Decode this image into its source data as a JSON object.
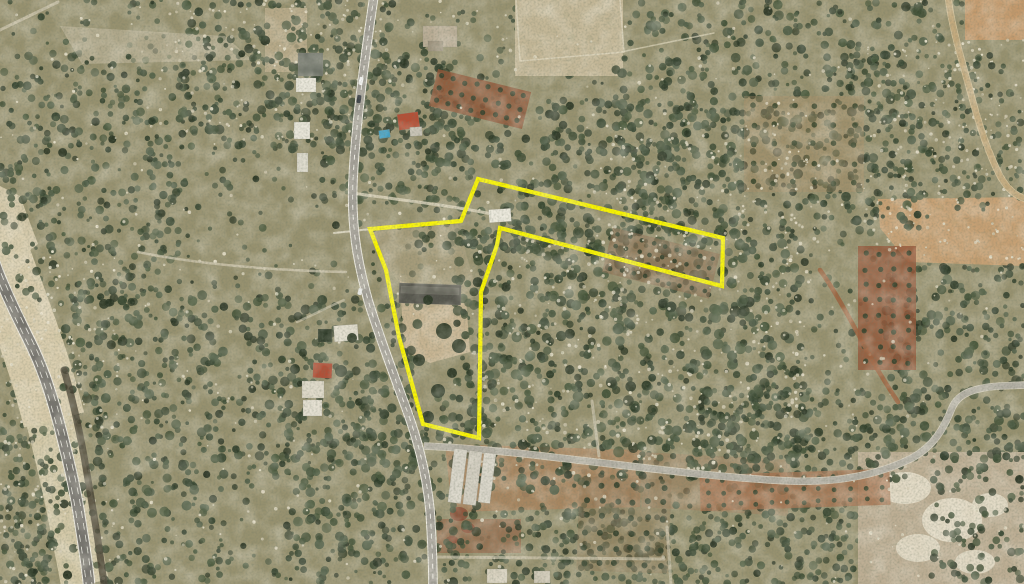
{
  "meta": {
    "title": "Aerial satellite view with highlighted land parcel",
    "width": 1024,
    "height": 584
  },
  "map": {
    "width": 1024,
    "height": 584,
    "seed": 1234,
    "base": "#97916f",
    "parcel": {
      "points": "478,179 723,238 722,286 500,228 497,245 481,292 479,438 423,424 399,337 386,270 370,229 461,221",
      "color": "#f9f400",
      "width": 4.2
    },
    "sand": [
      {
        "d": "M -8 236 C 4 268, 16 300, 30 340 C 40 368, 48 396, 54 420",
        "w": 62,
        "c": "#dbcfae",
        "o": 0.95
      },
      {
        "d": "M 50 420 C 58 452, 66 486, 72 516 C 77 544, 82 566, 85 584",
        "w": 48,
        "c": "#d8cdab",
        "o": 0.92
      }
    ],
    "channel": {
      "d": "M 64 370 C 72 396, 78 424, 84 456 C 89 486, 95 520, 99 548 C 101 562, 103 574, 104 584",
      "w": 7,
      "c": "#453e31",
      "o": 0.8
    },
    "highway": {
      "d": "M -6 262 C 2 285, 14 310, 28 338 C 42 366, 50 390, 58 420 C 66 450, 74 482, 79 514 C 83 540, 87 562, 89 584",
      "casing": "#efece3",
      "casingW": 12.6,
      "fill": "#76736e",
      "fillW": 10.6,
      "laneOffset": 2.9,
      "laneColor": "#e9e7df",
      "laneW": 0.8,
      "laneDash": "7 5"
    },
    "mainRoad": {
      "d": "M 374 -4 C 366 50, 356 120, 353 180 C 351 225, 357 260, 368 300 C 378 333, 392 370, 406 408 C 417 438, 426 470, 430 510 C 432 540, 433 565, 433 588",
      "casing": "#efece2",
      "casingW": 9.6,
      "fill": "#a5a199",
      "fillW": 7.6,
      "centerColor": "#f2f0e8",
      "centerW": 0.9,
      "centerDash": "5 5"
    },
    "ruralRoad": {
      "d": "M 424 446 C 470 448, 520 453, 560 458 C 640 467, 720 478, 790 481 C 840 483, 880 474, 912 458 C 934 446, 944 428, 952 408 C 958 394, 972 388, 1000 386 L 1026 385",
      "casing": "#d9d3c2",
      "casingW": 7.6,
      "fill": "#b2aea3",
      "fillW": 6
    },
    "dirtRoad": {
      "d": "M 948 -4 C 952 30, 962 60, 972 98 C 980 128, 988 152, 1000 176 C 1008 190, 1016 196, 1026 199",
      "casing": "#d9c79f",
      "casingW": 7,
      "fill": "#c2a97d",
      "fillW": 5.4
    },
    "patches": [
      {
        "t": "poly",
        "p": "0,186 20,196 38,244 10,266 0,264",
        "f": "#d9cdae",
        "o": 0.92
      },
      {
        "t": "rect",
        "x": 515,
        "y": 0,
        "w": 108,
        "h": 76,
        "rot": 0,
        "f": "#c9bb9b",
        "o": 0.9
      },
      {
        "t": "rect",
        "x": 265,
        "y": 8,
        "w": 42,
        "h": 64,
        "rot": 0,
        "f": "#c2b190",
        "o": 0.75
      },
      {
        "t": "poly",
        "p": "60,26 225,36 252,60 82,64",
        "f": "#cfc6ad",
        "o": 0.45
      },
      {
        "t": "rect",
        "x": 965,
        "y": 0,
        "w": 59,
        "h": 40,
        "rot": 0,
        "f": "#c59a6c",
        "o": 0.95
      },
      {
        "t": "poly",
        "p": "878,199 1024,197 1024,266 908,262 880,228",
        "f": "#c8a174",
        "o": 0.95
      },
      {
        "t": "rect",
        "x": 858,
        "y": 452,
        "w": 166,
        "h": 132,
        "rot": 0,
        "f": "#bfb096",
        "o": 0.95
      },
      {
        "t": "ellipse",
        "x": 905,
        "y": 488,
        "w": 26,
        "h": 16,
        "f": "#e9e1cd",
        "o": 0.85
      },
      {
        "t": "ellipse",
        "x": 952,
        "y": 520,
        "w": 30,
        "h": 22,
        "f": "#e9e1cd",
        "o": 0.85
      },
      {
        "t": "ellipse",
        "x": 918,
        "y": 548,
        "w": 22,
        "h": 14,
        "f": "#e9e1cd",
        "o": 0.8
      },
      {
        "t": "ellipse",
        "x": 990,
        "y": 505,
        "w": 18,
        "h": 12,
        "f": "#e9e1cd",
        "o": 0.8
      },
      {
        "t": "ellipse",
        "x": 975,
        "y": 562,
        "w": 20,
        "h": 12,
        "f": "#e9e1cd",
        "o": 0.8
      },
      {
        "t": "poly",
        "p": "400,281 466,298 470,352 430,363 404,350",
        "f": "#c9b694",
        "o": 0.95
      },
      {
        "t": "poly",
        "p": "372,232 458,224 478,296 462,300 420,310 388,268",
        "f": "#b3a686",
        "o": 0.5
      },
      {
        "t": "poly",
        "p": "445,444 642,450 640,507 452,512",
        "f": "#a9845f",
        "o": 0.85
      },
      {
        "t": "poly",
        "p": "640,452 790,460 788,516 642,507",
        "f": "#a08261",
        "o": 0.55
      },
      {
        "t": "rect",
        "x": 437,
        "y": 519,
        "w": 84,
        "h": 34,
        "rot": 0,
        "f": "#96684a",
        "o": 0.7
      },
      {
        "t": "ellipse",
        "x": 459,
        "y": 514,
        "w": 9,
        "h": 7,
        "f": "#8a4a34",
        "o": 0.8
      },
      {
        "t": "ellipse",
        "x": 468,
        "y": 528,
        "w": 7,
        "h": 5,
        "f": "#8a4a34",
        "o": 0.75
      },
      {
        "t": "ellipse",
        "x": 452,
        "y": 540,
        "w": 6,
        "h": 4,
        "f": "#8a4a34",
        "o": 0.7
      }
    ],
    "treeColors": [
      "#2e3c29",
      "#374631",
      "#3f4e35",
      "#47563b",
      "#2a3524",
      "#505e47"
    ],
    "treeZones": [
      {
        "x": 0,
        "y": 0,
        "w": 1024,
        "h": 584,
        "n": 1500,
        "rmin": 1.5,
        "rmax": 4
      },
      {
        "x": 180,
        "y": 0,
        "w": 215,
        "h": 150,
        "n": 280,
        "rmin": 2,
        "rmax": 5
      },
      {
        "x": 320,
        "y": 55,
        "w": 130,
        "h": 150,
        "n": 170,
        "rmin": 2,
        "rmax": 5
      },
      {
        "x": 415,
        "y": 100,
        "w": 330,
        "h": 150,
        "n": 400,
        "rmin": 2,
        "rmax": 5
      },
      {
        "x": 455,
        "y": 225,
        "w": 350,
        "h": 265,
        "n": 800,
        "rmin": 2,
        "rmax": 5.5
      },
      {
        "x": 615,
        "y": 0,
        "w": 320,
        "h": 235,
        "n": 420,
        "rmin": 2,
        "rmax": 5
      },
      {
        "x": 0,
        "y": 55,
        "w": 185,
        "h": 250,
        "n": 280,
        "rmin": 2,
        "rmax": 4.5
      },
      {
        "x": 55,
        "y": 290,
        "w": 170,
        "h": 294,
        "n": 330,
        "rmin": 2,
        "rmax": 5
      },
      {
        "x": 0,
        "y": 430,
        "w": 55,
        "h": 154,
        "n": 120,
        "rmin": 2,
        "rmax": 4.5
      },
      {
        "x": 235,
        "y": 295,
        "w": 185,
        "h": 175,
        "n": 260,
        "rmin": 2,
        "rmax": 5
      },
      {
        "x": 285,
        "y": 415,
        "w": 195,
        "h": 169,
        "n": 240,
        "rmin": 2,
        "rmax": 5
      },
      {
        "x": 495,
        "y": 505,
        "w": 360,
        "h": 79,
        "n": 300,
        "rmin": 2,
        "rmax": 4.5
      },
      {
        "x": 885,
        "y": 265,
        "w": 139,
        "h": 195,
        "n": 230,
        "rmin": 2,
        "rmax": 5
      },
      {
        "x": 695,
        "y": 385,
        "w": 210,
        "h": 95,
        "n": 170,
        "rmin": 2,
        "rmax": 4.5
      },
      {
        "x": 820,
        "y": 55,
        "w": 204,
        "h": 165,
        "n": 190,
        "rmin": 1.8,
        "rmax": 4
      },
      {
        "x": 930,
        "y": 455,
        "w": 94,
        "h": 129,
        "n": 100,
        "rmin": 2,
        "rmax": 4.5
      }
    ],
    "rockColors": [
      "#ddd6c0",
      "#e8e1cb",
      "#cfc7ae"
    ],
    "rockZones": [
      {
        "x": 0,
        "y": 0,
        "w": 1024,
        "h": 584,
        "n": 600,
        "rmin": 0.7,
        "rmax": 1.9
      },
      {
        "x": 470,
        "y": 240,
        "w": 340,
        "h": 240,
        "n": 320,
        "rmin": 0.7,
        "rmax": 2
      },
      {
        "x": 160,
        "y": 0,
        "w": 240,
        "h": 140,
        "n": 140,
        "rmin": 0.7,
        "rmax": 1.8
      },
      {
        "x": 0,
        "y": 250,
        "w": 120,
        "h": 334,
        "n": 160,
        "rmin": 0.7,
        "rmax": 1.8
      },
      {
        "x": 860,
        "y": 40,
        "w": 164,
        "h": 220,
        "n": 160,
        "rmin": 0.7,
        "rmax": 1.8
      },
      {
        "x": 600,
        "y": 120,
        "w": 220,
        "h": 120,
        "n": 120,
        "rmin": 0.7,
        "rmax": 1.8
      }
    ],
    "orchards": [
      {
        "x": 606,
        "y": 240,
        "w": 110,
        "h": 46,
        "rot": 14,
        "rows": 4,
        "cols": 9,
        "r": 2.3,
        "soil": "#8a6a4c",
        "soilOp": 0.55,
        "dot": "#36432e"
      },
      {
        "x": 858,
        "y": 246,
        "w": 58,
        "h": 124,
        "rot": 0,
        "rows": 8,
        "cols": 4,
        "r": 2.6,
        "soil": "#95563a",
        "soilOp": 0.8,
        "dot": "#3a452f"
      },
      {
        "x": 432,
        "y": 80,
        "w": 96,
        "h": 38,
        "rot": 14,
        "rows": 3,
        "cols": 8,
        "r": 2.6,
        "soil": "#8e5638",
        "soilOp": 0.85,
        "dot": "#37422d"
      },
      {
        "x": 578,
        "y": 478,
        "w": 92,
        "h": 94,
        "rot": 2,
        "rows": 6,
        "cols": 6,
        "r": 3,
        "soil": "#8f7656",
        "soilOp": 0.4,
        "dot": "#35412c"
      },
      {
        "x": 700,
        "y": 472,
        "w": 190,
        "h": 36,
        "rot": -2,
        "rows": 3,
        "cols": 12,
        "r": 2.4,
        "soil": "#a5704e",
        "soilOp": 0.75,
        "dot": "#414c36"
      },
      {
        "x": 744,
        "y": 96,
        "w": 120,
        "h": 96,
        "rot": 0,
        "rows": 5,
        "cols": 6,
        "r": 2.8,
        "soil": "#b29066",
        "soilOp": 0.3,
        "dot": "#3c482f"
      }
    ],
    "walls": [
      {
        "d": "M 516 0 L 520 61 L 624 52 L 620 0",
        "w": 1.5,
        "c": "#ded5bb",
        "o": 0.8
      },
      {
        "d": "M 621 52 L 714 33",
        "w": 1.5,
        "c": "#ded5bb",
        "o": 0.7
      },
      {
        "d": "M 334 233 L 371 229",
        "w": 2,
        "c": "#e8e2cf",
        "o": 0.8
      }
    ],
    "tracks": [
      {
        "d": "M 352 193 C 392 199, 442 204, 492 214",
        "w": 3,
        "c": "#d9d1ba",
        "o": 0.85
      },
      {
        "d": "M 138 252 C 192 263, 262 270, 346 272",
        "w": 2.5,
        "c": "#d5cdb6",
        "o": 0.7
      },
      {
        "d": "M 592 401 L 599 456",
        "w": 3,
        "c": "#cfc7b0",
        "o": 0.7
      },
      {
        "d": "M 434 557 L 664 559",
        "w": 3,
        "c": "#d5cdb6",
        "o": 0.65
      },
      {
        "d": "M 667 527 L 671 584",
        "w": 3,
        "c": "#d5cdb6",
        "o": 0.6
      },
      {
        "d": "M 0 30 L 58 2",
        "w": 3,
        "c": "#d3cbb4",
        "o": 0.7
      },
      {
        "d": "M 820 270 C 836 292, 856 330, 872 360 C 880 374, 890 390, 898 402",
        "w": 4.5,
        "c": "#9c5f3c",
        "o": 0.85
      },
      {
        "d": "M 297 322 C 315 314, 330 306, 344 300",
        "w": 2.5,
        "c": "#d5cdb6",
        "o": 0.6
      }
    ],
    "buildings": [
      [
        298,
        53,
        25,
        23,
        0,
        "#70746a"
      ],
      [
        296,
        78,
        20,
        14,
        0,
        "#e9e6da"
      ],
      [
        294,
        122,
        16,
        17,
        0,
        "#e7e4d8"
      ],
      [
        297,
        153,
        11,
        19,
        0,
        "#dcd9cc"
      ],
      [
        423,
        26,
        34,
        21,
        0,
        "#b9ac95"
      ],
      [
        428,
        41,
        15,
        10,
        0,
        "#9d927d"
      ],
      [
        398,
        113,
        21,
        16,
        -8,
        "#b44f36"
      ],
      [
        410,
        127,
        12,
        9,
        -4,
        "#c6c1b4"
      ],
      [
        379,
        130,
        11,
        8,
        -8,
        "#3f9fc4"
      ],
      [
        489,
        209,
        22,
        13,
        -4,
        "#ece9dd"
      ],
      [
        399,
        284,
        62,
        20,
        2,
        "#56554d"
      ],
      [
        401,
        287,
        58,
        7,
        2,
        "#6a695f"
      ],
      [
        313,
        363,
        19,
        15,
        3,
        "#b05038"
      ],
      [
        302,
        381,
        22,
        17,
        0,
        "#ddd7c7"
      ],
      [
        303,
        400,
        19,
        16,
        0,
        "#e4dfd1"
      ],
      [
        334,
        325,
        24,
        16,
        -4,
        "#e1dccd"
      ],
      [
        318,
        329,
        14,
        13,
        0,
        "#2e3a28"
      ],
      [
        451,
        449,
        13,
        54,
        7,
        "#d8d4c8"
      ],
      [
        466,
        451,
        13,
        54,
        7,
        "#cfcabd"
      ],
      [
        481,
        453,
        12,
        50,
        7,
        "#d8d4c8"
      ],
      [
        487,
        569,
        20,
        14,
        0,
        "#d8d1bf"
      ],
      [
        534,
        571,
        16,
        12,
        0,
        "#cec7b5"
      ]
    ],
    "canopyColor": "#2c3826",
    "canopies": [
      [
        444,
        331,
        8
      ],
      [
        459,
        346,
        7
      ],
      [
        428,
        300,
        5
      ],
      [
        419,
        360,
        6
      ],
      [
        438,
        391,
        7
      ],
      [
        428,
        417,
        6
      ],
      [
        452,
        373,
        5
      ],
      [
        341,
        371,
        6
      ],
      [
        295,
        369,
        5
      ],
      [
        352,
        338,
        5
      ]
    ],
    "cars": [
      [
        359,
        77,
        4,
        8,
        12,
        "#f3f3f1"
      ],
      [
        357,
        95,
        4,
        8,
        8,
        "#383d43"
      ],
      [
        358,
        288,
        4,
        7,
        14,
        "#e9e9e7"
      ]
    ]
  }
}
